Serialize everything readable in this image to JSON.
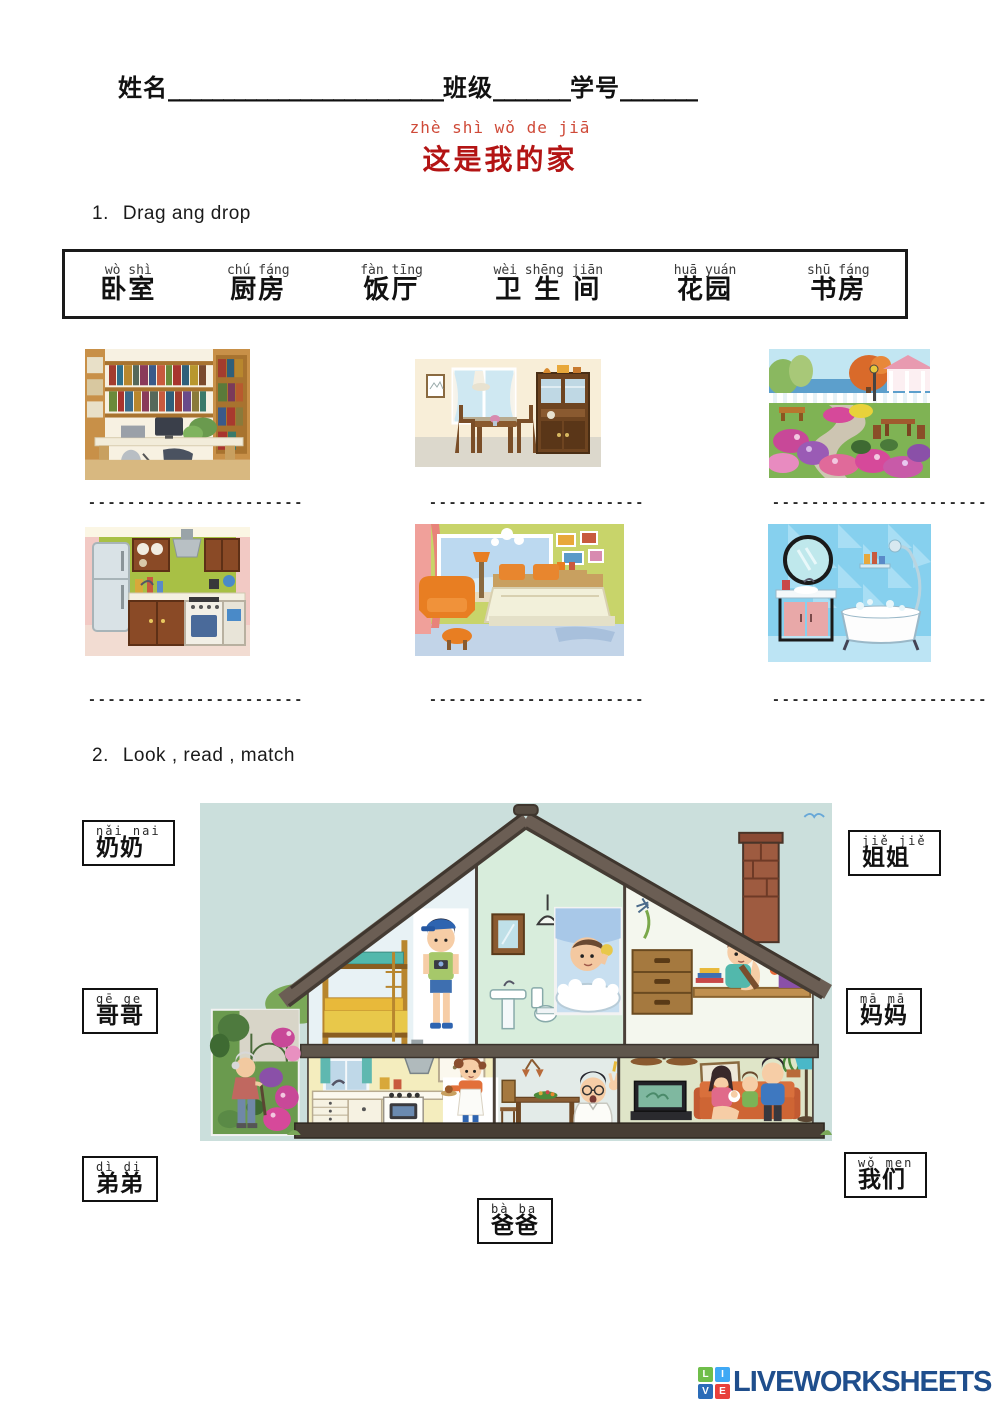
{
  "header": {
    "name_label": "姓名",
    "name_blank": "_________________________",
    "class_label": "班级",
    "class_blank": "_______",
    "id_label": "学号",
    "id_blank": "_______"
  },
  "title": {
    "pinyin": "zhè shì wǒ de jiā",
    "hanzi": "这是我的家",
    "pinyin_color": "#cf4a38",
    "hanzi_color": "#b31414"
  },
  "section1": {
    "number": "1.",
    "heading": "Drag ang drop",
    "wordbank": [
      {
        "pinyin": "wò shì",
        "hanzi": "卧室"
      },
      {
        "pinyin": "chú fáng",
        "hanzi": "厨房"
      },
      {
        "pinyin": "fàn tīng",
        "hanzi": "饭厅"
      },
      {
        "pinyin": "wèi shēng jiān",
        "hanzi": "卫 生 间"
      },
      {
        "pinyin": "huā yuán",
        "hanzi": "花园"
      },
      {
        "pinyin": "shū fáng",
        "hanzi": "书房"
      }
    ],
    "images": [
      "study-room",
      "dining-room",
      "garden",
      "kitchen",
      "bedroom",
      "bathroom"
    ],
    "answer_blank": "----------------------"
  },
  "section2": {
    "number": "2.",
    "heading": "Look , read , match",
    "labels": [
      {
        "id": "nainai",
        "pinyin": "nǎi nai",
        "hanzi": "奶奶"
      },
      {
        "id": "jiejie",
        "pinyin": "jiě jiě",
        "hanzi": "姐姐"
      },
      {
        "id": "gege",
        "pinyin": "gē ge",
        "hanzi": "哥哥"
      },
      {
        "id": "mama",
        "pinyin": "mā mā",
        "hanzi": "妈妈"
      },
      {
        "id": "didi",
        "pinyin": "dì di",
        "hanzi": "弟弟"
      },
      {
        "id": "women",
        "pinyin": "wǒ men",
        "hanzi": "我们"
      },
      {
        "id": "baba",
        "pinyin": "bà ba",
        "hanzi": "爸爸"
      }
    ]
  },
  "footer": {
    "brand": "LIVEWORKSHEETS",
    "brand_color": "#1f4e8c",
    "logo_letters": [
      "L",
      "I",
      "V",
      "E"
    ],
    "logo_colors": [
      "#6fbe4a",
      "#3fa9f5",
      "#2b6cb8",
      "#e8413c"
    ]
  }
}
